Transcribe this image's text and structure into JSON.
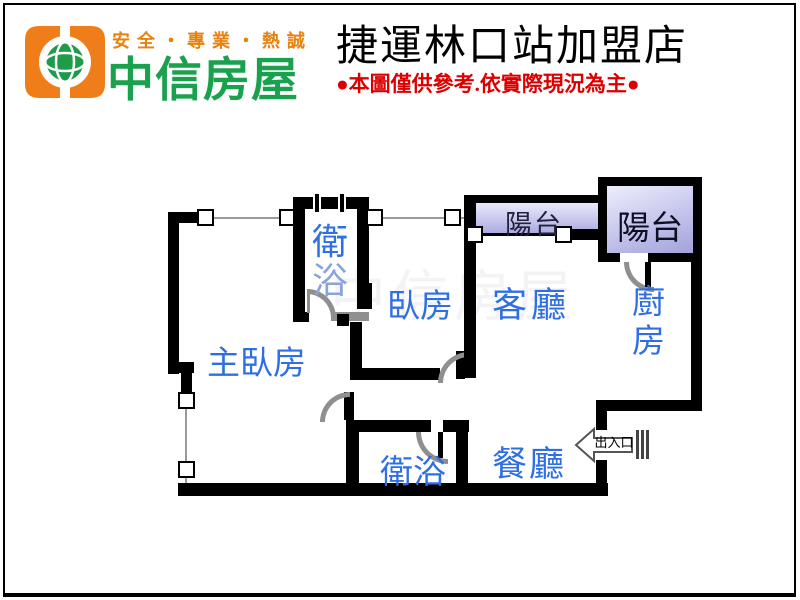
{
  "page": {
    "background": "#ffffff",
    "frame_color": "#000000"
  },
  "header": {
    "logo": {
      "tagline": "安全・專業・熱誠",
      "brand": "中信房屋",
      "orange": "#ef7d1a",
      "green": "#1aa14e",
      "tagline_color": "#e8820e"
    },
    "store_name": "捷運林口站加盟店",
    "disclaimer": "●本圖僅供參考.依實際現況為主●",
    "disclaimer_color": "#dd0000"
  },
  "floorplan": {
    "colors": {
      "wall": "#000000",
      "door_arc": "#8f8f8f",
      "room_label": "#2f6fe4",
      "balcony_label": "#14142e",
      "balcony_fill_top": "#e9e9fb",
      "balcony_fill_bottom": "#a6a6dd"
    },
    "rooms": {
      "master_bedroom": {
        "label": "主臥房"
      },
      "bathroom_top": {
        "chars": [
          "衛",
          "浴"
        ]
      },
      "bedroom": {
        "label": "臥房"
      },
      "living_room": {
        "label": "客廳"
      },
      "kitchen": {
        "chars": [
          "廚",
          "房"
        ]
      },
      "dining_room": {
        "label": "餐廳"
      },
      "bathroom_bottom": {
        "label": "衛浴"
      },
      "balcony_front": {
        "label": "陽台"
      },
      "balcony_kitchen": {
        "label": "陽台"
      }
    },
    "entrance": {
      "label": "出入口"
    },
    "watermark": "中信房屋"
  }
}
